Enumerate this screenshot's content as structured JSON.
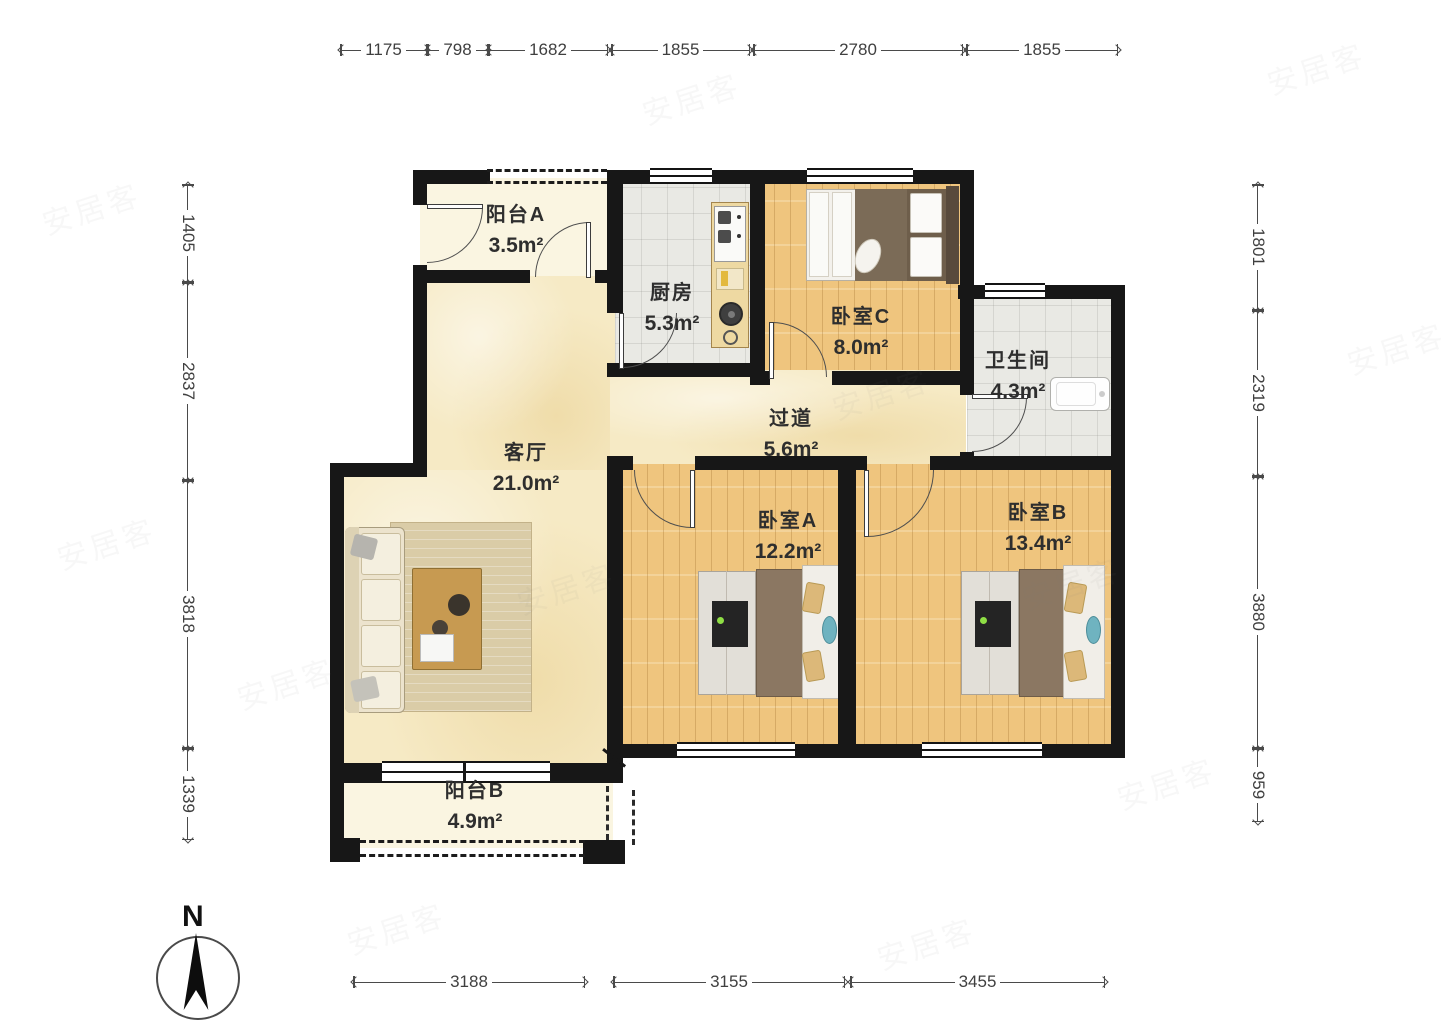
{
  "compass": {
    "label": "N"
  },
  "watermark": {
    "text": "安居客"
  },
  "rooms": [
    {
      "id": "balcony-a",
      "name": "阳台A",
      "area": "3.5m²",
      "cx": 516,
      "cy": 198
    },
    {
      "id": "kitchen",
      "name": "厨房",
      "area": "5.3m²",
      "cx": 672,
      "cy": 276
    },
    {
      "id": "bedroom-c",
      "name": "卧室C",
      "area": "8.0m²",
      "cx": 861,
      "cy": 300
    },
    {
      "id": "bathroom",
      "name": "卫生间",
      "area": "4.3m²",
      "cx": 1018,
      "cy": 344
    },
    {
      "id": "hallway",
      "name": "过道",
      "area": "5.6m²",
      "cx": 791,
      "cy": 402
    },
    {
      "id": "living-room",
      "name": "客厅",
      "area": "21.0m²",
      "cx": 526,
      "cy": 436
    },
    {
      "id": "bedroom-a",
      "name": "卧室A",
      "area": "12.2m²",
      "cx": 788,
      "cy": 504
    },
    {
      "id": "bedroom-b",
      "name": "卧室B",
      "area": "13.4m²",
      "cx": 1038,
      "cy": 496
    },
    {
      "id": "balcony-b",
      "name": "阳台B",
      "area": "4.9m²",
      "cx": 475,
      "cy": 774
    }
  ],
  "dimensions": {
    "top_y": 50,
    "top": [
      {
        "label": "1175",
        "x1": 340,
        "x2": 427
      },
      {
        "label": "798",
        "x1": 427,
        "x2": 488
      },
      {
        "label": "1682",
        "x1": 488,
        "x2": 608
      },
      {
        "label": "1855",
        "x1": 611,
        "x2": 750
      },
      {
        "label": "2780",
        "x1": 753,
        "x2": 963
      },
      {
        "label": "1855",
        "x1": 966,
        "x2": 1118
      }
    ],
    "bottom_y": 982,
    "bottom": [
      {
        "label": "3188",
        "x1": 353,
        "x2": 585
      },
      {
        "label": "3155",
        "x1": 613,
        "x2": 845
      },
      {
        "label": "3455",
        "x1": 850,
        "x2": 1105
      }
    ],
    "left_x": 188,
    "left": [
      {
        "label": "1405",
        "y1": 184,
        "y2": 282
      },
      {
        "label": "2837",
        "y1": 282,
        "y2": 480
      },
      {
        "label": "3818",
        "y1": 480,
        "y2": 748
      },
      {
        "label": "1339",
        "y1": 748,
        "y2": 840
      }
    ],
    "right_x": 1258,
    "right": [
      {
        "label": "1801",
        "y1": 184,
        "y2": 310
      },
      {
        "label": "2319",
        "y1": 310,
        "y2": 476
      },
      {
        "label": "3880",
        "y1": 476,
        "y2": 748
      },
      {
        "label": "959",
        "y1": 748,
        "y2": 822
      }
    ]
  },
  "watermark_spots": [
    [
      40,
      185
    ],
    [
      55,
      520
    ],
    [
      235,
      660
    ],
    [
      640,
      75
    ],
    [
      830,
      370
    ],
    [
      515,
      565
    ],
    [
      1020,
      560
    ],
    [
      1265,
      45
    ],
    [
      1345,
      325
    ],
    [
      1115,
      760
    ],
    [
      875,
      920
    ],
    [
      345,
      905
    ]
  ]
}
